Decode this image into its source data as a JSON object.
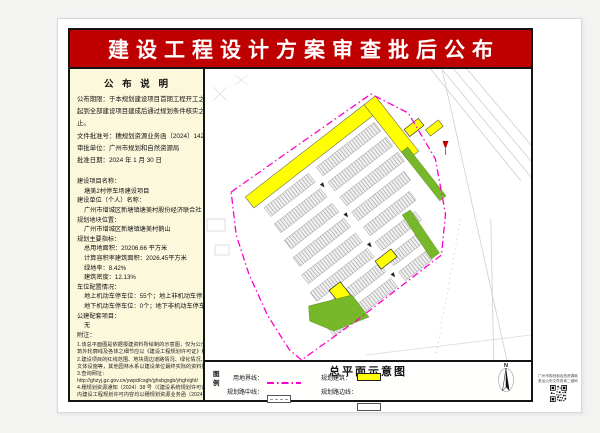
{
  "banner": {
    "title": "建设工程设计方案审查批后公布"
  },
  "notice": {
    "heading": "公 布 说 明",
    "intro_lines": [
      "公布期限：于本规划建设项目首期工程开工之日",
      "起到全部建设项目建成后通过规划条件核实之日",
      "止。",
      "文件批准号：穗规划资源业务函〔2024〕1426号",
      "审批单位：广州市规划和自然资源局",
      "批准日期：2024 年 1 月 30 日"
    ],
    "detail_lines": [
      {
        "t": "建设项目名称：",
        "c": "label"
      },
      {
        "t": "塘美2村停车场建设项目",
        "c": "indent"
      },
      {
        "t": "建设单位（个人）名称：",
        "c": "label"
      },
      {
        "t": "广州市增城区新塘镇塘美村股份经济联合社",
        "c": "indent"
      },
      {
        "t": "规划地块位置：",
        "c": "label"
      },
      {
        "t": "广州市增城区新塘镇塘美村鹅山",
        "c": "indent"
      },
      {
        "t": "规划主要指标：",
        "c": "label"
      },
      {
        "t": "总用地面积：20206.66 平方米",
        "c": "indent"
      },
      {
        "t": "计算容积率建筑面积：2026.45平方米",
        "c": "indent"
      },
      {
        "t": "绿地率：8.42%",
        "c": "indent"
      },
      {
        "t": "建筑密度：12.13%",
        "c": "indent"
      },
      {
        "t": "车位配置情况：",
        "c": "label"
      },
      {
        "t": "地上机动车停车位：55个；地上非机动车停车位：0个；",
        "c": "indent"
      },
      {
        "t": "地下机动车停车位：0个；地下非机动车停车位：0个",
        "c": "indent"
      },
      {
        "t": "公建配套项目：",
        "c": "label"
      },
      {
        "t": "无",
        "c": "indent"
      },
      {
        "t": "附注：",
        "c": "label"
      }
    ],
    "notes": [
      "1.该总平面图是依据报建资料所绘制的示意图，仅为公示使用，图上标注的建",
      "筑外轮廓线及各体之细节应以《建设工程规划许可证》核定为准。",
      "2.建设项目的红线范围、地块周边道路情况、绿化情况、园林水系、水系、",
      "文体设施等，其他园林水系以建设单位最终实际的资料批复为准。",
      "3.查询网址：",
      "http://ghzyj.gz.gov.cn/ywpd/csgh/ghsbgsgb/yhgh/ght/",
      "4.穗规划资源通知〔2024〕38 号（《建设系统规划许可证》）所批复的内容",
      "内建设工程规划许可内容均以穗规划资源业务函〔2024〕1426号批复文件为准。"
    ]
  },
  "legend": {
    "label": "图例",
    "title": "总平面示意图",
    "north_label": "N",
    "items": {
      "boundary": "用地界线：",
      "building": "规划建筑：",
      "centerline": "规划路中线：",
      "edgeline": "规划路边线："
    }
  },
  "qr": {
    "line1": "广州市规划和自然资源局",
    "line2": "批后公布文件查询二维码"
  },
  "colors": {
    "banner": "#bf0000",
    "panel_bg": "#fcf8dc",
    "boundary": "#ff00cc",
    "building": "#ffff00",
    "green": "#76b82a"
  }
}
